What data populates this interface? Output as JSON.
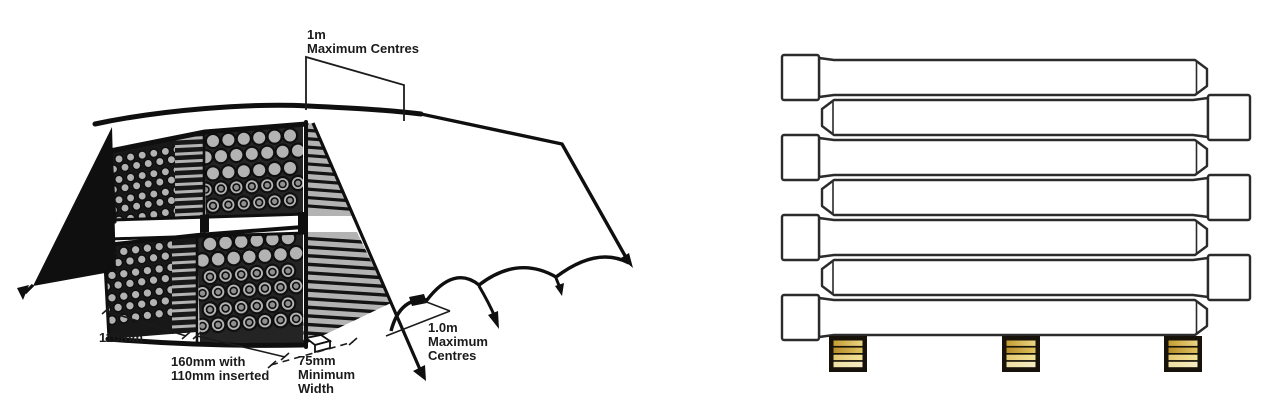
{
  "figure": {
    "left_diagram": {
      "labels": {
        "top_centres": {
          "line1": "1m",
          "line2": "Maximum Centres"
        },
        "width_110": {
          "line1": "110mm"
        },
        "width_160": {
          "line1": "160mm with",
          "line2": "110mm inserted"
        },
        "width_75": {
          "line1": "75mm",
          "line2": "Minimum",
          "line3": "Width"
        },
        "peg_centres": {
          "line1": "1.0m",
          "line2": "Maximum",
          "line3": "Centres"
        }
      },
      "stack": {
        "tiers": 2,
        "upper": {
          "small": {
            "cols": 6,
            "rows": 7
          },
          "large": {
            "cols": 6,
            "rows": 5
          }
        },
        "lower": {
          "small": {
            "cols": 6,
            "rows": 7
          },
          "large": {
            "cols": 6,
            "rows": 6
          }
        }
      },
      "colors": {
        "ink": "#0f0f0f",
        "pipe_end_gray": "#b3b3b3"
      }
    },
    "right_diagram": {
      "pipe_rows": 7,
      "socket_pattern": [
        "left",
        "right",
        "left",
        "right",
        "left",
        "right",
        "left"
      ],
      "bearer_count": 3,
      "colors": {
        "outline": "#2b2b2b",
        "bearer_frame": "#17120a",
        "bearer_stripes": [
          "#c59d32",
          "#b78d2a",
          "#e4c873",
          "#efe0a2"
        ],
        "bearer_stripe_highlights": [
          "#ecd584",
          "#dec25e",
          "#f2e296",
          "#f6ecc0"
        ]
      }
    }
  }
}
